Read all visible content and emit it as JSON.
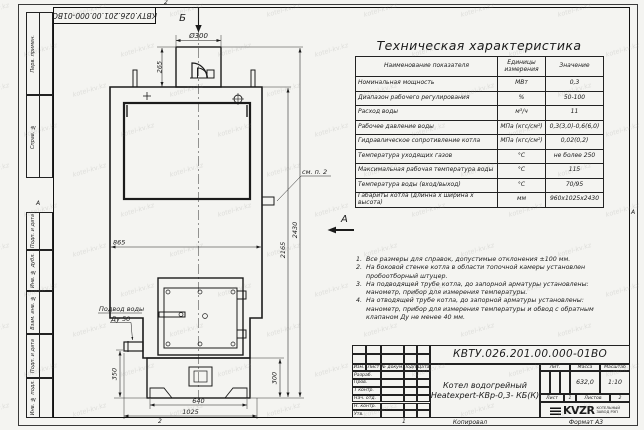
{
  "watermark": {
    "text": "kotel-kv.kz"
  },
  "frame": {
    "doc_number": "КВТУ.026.201.00.000-01ВО",
    "stamp_columns": [
      "Перв. примен.",
      "Справ. №",
      "Подп. и дата",
      "Инв. № дубл.",
      "Взам. инв. №",
      "Подп. и дата",
      "Инв. № подл."
    ],
    "zone_letter_left": "А",
    "zone_letter_right": "А",
    "zone_number_top": "2",
    "zone_number_bottom_left": "2",
    "zone_number_bottom_right": "1",
    "copied_label": "Копировал",
    "format_label": "Формат А3"
  },
  "spec_table": {
    "title": "Техническая характеристика",
    "col_headers": [
      "Наименование показателя",
      "Единицы измерения",
      "Значение"
    ],
    "rows": [
      {
        "name": "Номинальная мощность",
        "unit": "МВт",
        "value": "0,3"
      },
      {
        "name": "Диапазон рабочего регулирования",
        "unit": "%",
        "value": "50-100"
      },
      {
        "name": "Расход воды",
        "unit": "м³/ч",
        "value": "11"
      },
      {
        "name": "Рабочее давление воды",
        "unit": "МПа (кгс/см²)",
        "value": "0,3(3,0)-0,6(6,0)"
      },
      {
        "name": "Гидравлическое сопротивление котла",
        "unit": "МПа (кгс/см²)",
        "value": "0,02(0,2)"
      },
      {
        "name": "Температура уходящих газов",
        "unit": "°С",
        "value": "не более 250"
      },
      {
        "name": "Максимальная рабочая температура воды",
        "unit": "°С",
        "value": "115"
      },
      {
        "name": "Температура воды (вход/выход)",
        "unit": "°С",
        "value": "70/95"
      },
      {
        "name": "Габариты котла (длинна х ширина х высота)",
        "unit": "мм",
        "value": "960х1025х2430"
      }
    ]
  },
  "notes": [
    {
      "num": "1.",
      "text": "Все размеры для справок, допустимые отклонения ±100 мм."
    },
    {
      "num": "2.",
      "text": "На боковой стенке котла в области топочной камеры установлен пробоотборный штуцер."
    },
    {
      "num": "3.",
      "text": "На подводящей трубе котла, до запорной арматуры установлены: манометр, прибор для измерения температуры."
    },
    {
      "num": "4.",
      "text": "На отводящей трубе котла, до запорной арматуры установлены: манометр, прибор для измерения температуры и обвод с обратным клапаном Ду не менее 40 мм."
    }
  ],
  "drawing": {
    "view_b": "Б",
    "view_a": "А",
    "dim_flue_diameter": "Ø300",
    "dim_flue_height": "265",
    "dim_body_width": "865",
    "dim_height_body": "2165",
    "dim_height_total": "2430",
    "dim_inlet_height": "350",
    "dim_base_height": "300",
    "dim_base_width": "640",
    "dim_base_depth": "1025",
    "label_water_inlet_1": "Подвод воды",
    "label_water_inlet_2": "Ду 50",
    "label_see_note": "см. п. 2"
  },
  "title_block": {
    "doc_number": "КВТУ.026.201.00.000-01ВО",
    "header_cells": [
      "Изм.",
      "Лист",
      "№ докум.",
      "Подп.",
      "Дата"
    ],
    "sign_rows": [
      "Разраб.",
      "Пров.",
      "Т контр.",
      "Нач. отд.",
      "Н. контр.",
      "Утв."
    ],
    "product_name_1": "Котел водогрейный",
    "product_name_2": "Heatexpert-КВр-0,3- КБ(К)",
    "lit_label": "Лит.",
    "mass_label": "Масса",
    "scale_label": "Масштаб",
    "mass_value": "632,0",
    "scale_value": "1:10",
    "sheet_label": "Лист",
    "sheet_value": "1",
    "sheets_label": "Листов",
    "sheets_value": "2",
    "logo_text": "KVZR",
    "logo_sub_1": "КОТЕЛЬНЫЙ",
    "logo_sub_2": "ЗАВОД РЭП"
  }
}
